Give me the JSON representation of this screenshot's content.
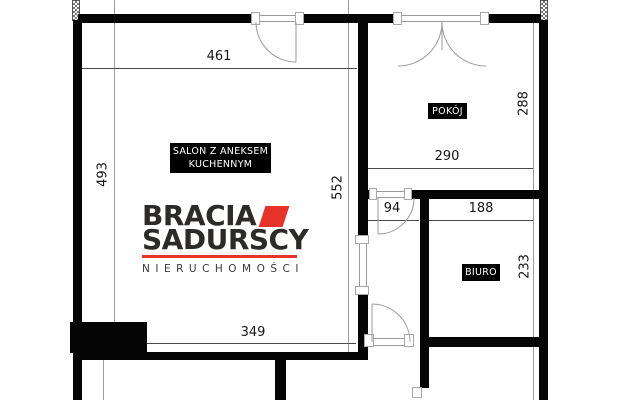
{
  "plan": {
    "type": "apartment floor plan",
    "language": "pl"
  },
  "rooms": {
    "salon": {
      "line1": "SALON Z ANEKSEM",
      "line2": "KUCHENNYM"
    },
    "pokoj": {
      "label": "POKÓJ"
    },
    "biuro": {
      "label": "BIURO"
    }
  },
  "dims": {
    "salon_top_width": "461",
    "salon_left_height": "493",
    "salon_right_height": "552",
    "pokoj_right_height": "288",
    "pokoj_bottom_width": "290",
    "hall_width": "94",
    "biuro_top_width": "188",
    "biuro_right_height": "233",
    "salon_bottom_width": "349"
  },
  "logo": {
    "line1": "BRACIA",
    "line2": "SADURSCY",
    "subtitle": "NIERUCHOMOŚCI"
  },
  "colors": {
    "wall": "#050505",
    "accent_red": "#e63329",
    "dim_text": "#151515",
    "thin_line": "#9c9c9c",
    "logo_text": "#2c2b2a"
  }
}
